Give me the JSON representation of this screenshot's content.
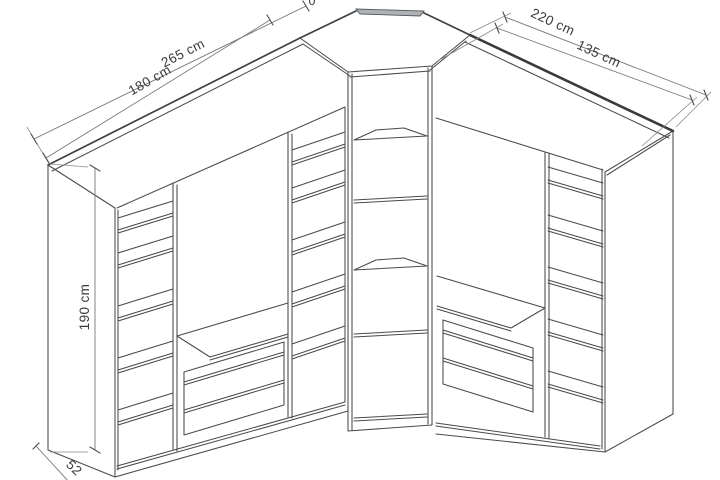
{
  "drawing": {
    "type": "furniture-technical-line-drawing",
    "subject": "L-shaped corner wardrobe with open shelf columns, hanging sections and drawers",
    "background_color": "#ffffff",
    "line_color": "#4a4a4a",
    "dimension_line_color": "#777777",
    "label_color": "#3a3a3a",
    "corner_back_strip_color": "#aeb2b6"
  },
  "units": {
    "left_wardrobe": "left wardrobe unit with two shelf columns, middle hanging bay, bench shelf and drawers",
    "corner_cabinet": "center corner cabinet with two corner shelves",
    "right_wardrobe": "right wardrobe unit with hanging bay, drawers and right shelf column"
  },
  "dimensions": {
    "left_total_width": "265 cm",
    "left_front_width": "180 cm",
    "right_total_width": "220 cm",
    "right_front_width": "135 cm",
    "height": "190 cm",
    "depth": "52",
    "top_edge_partial_label": "0"
  }
}
